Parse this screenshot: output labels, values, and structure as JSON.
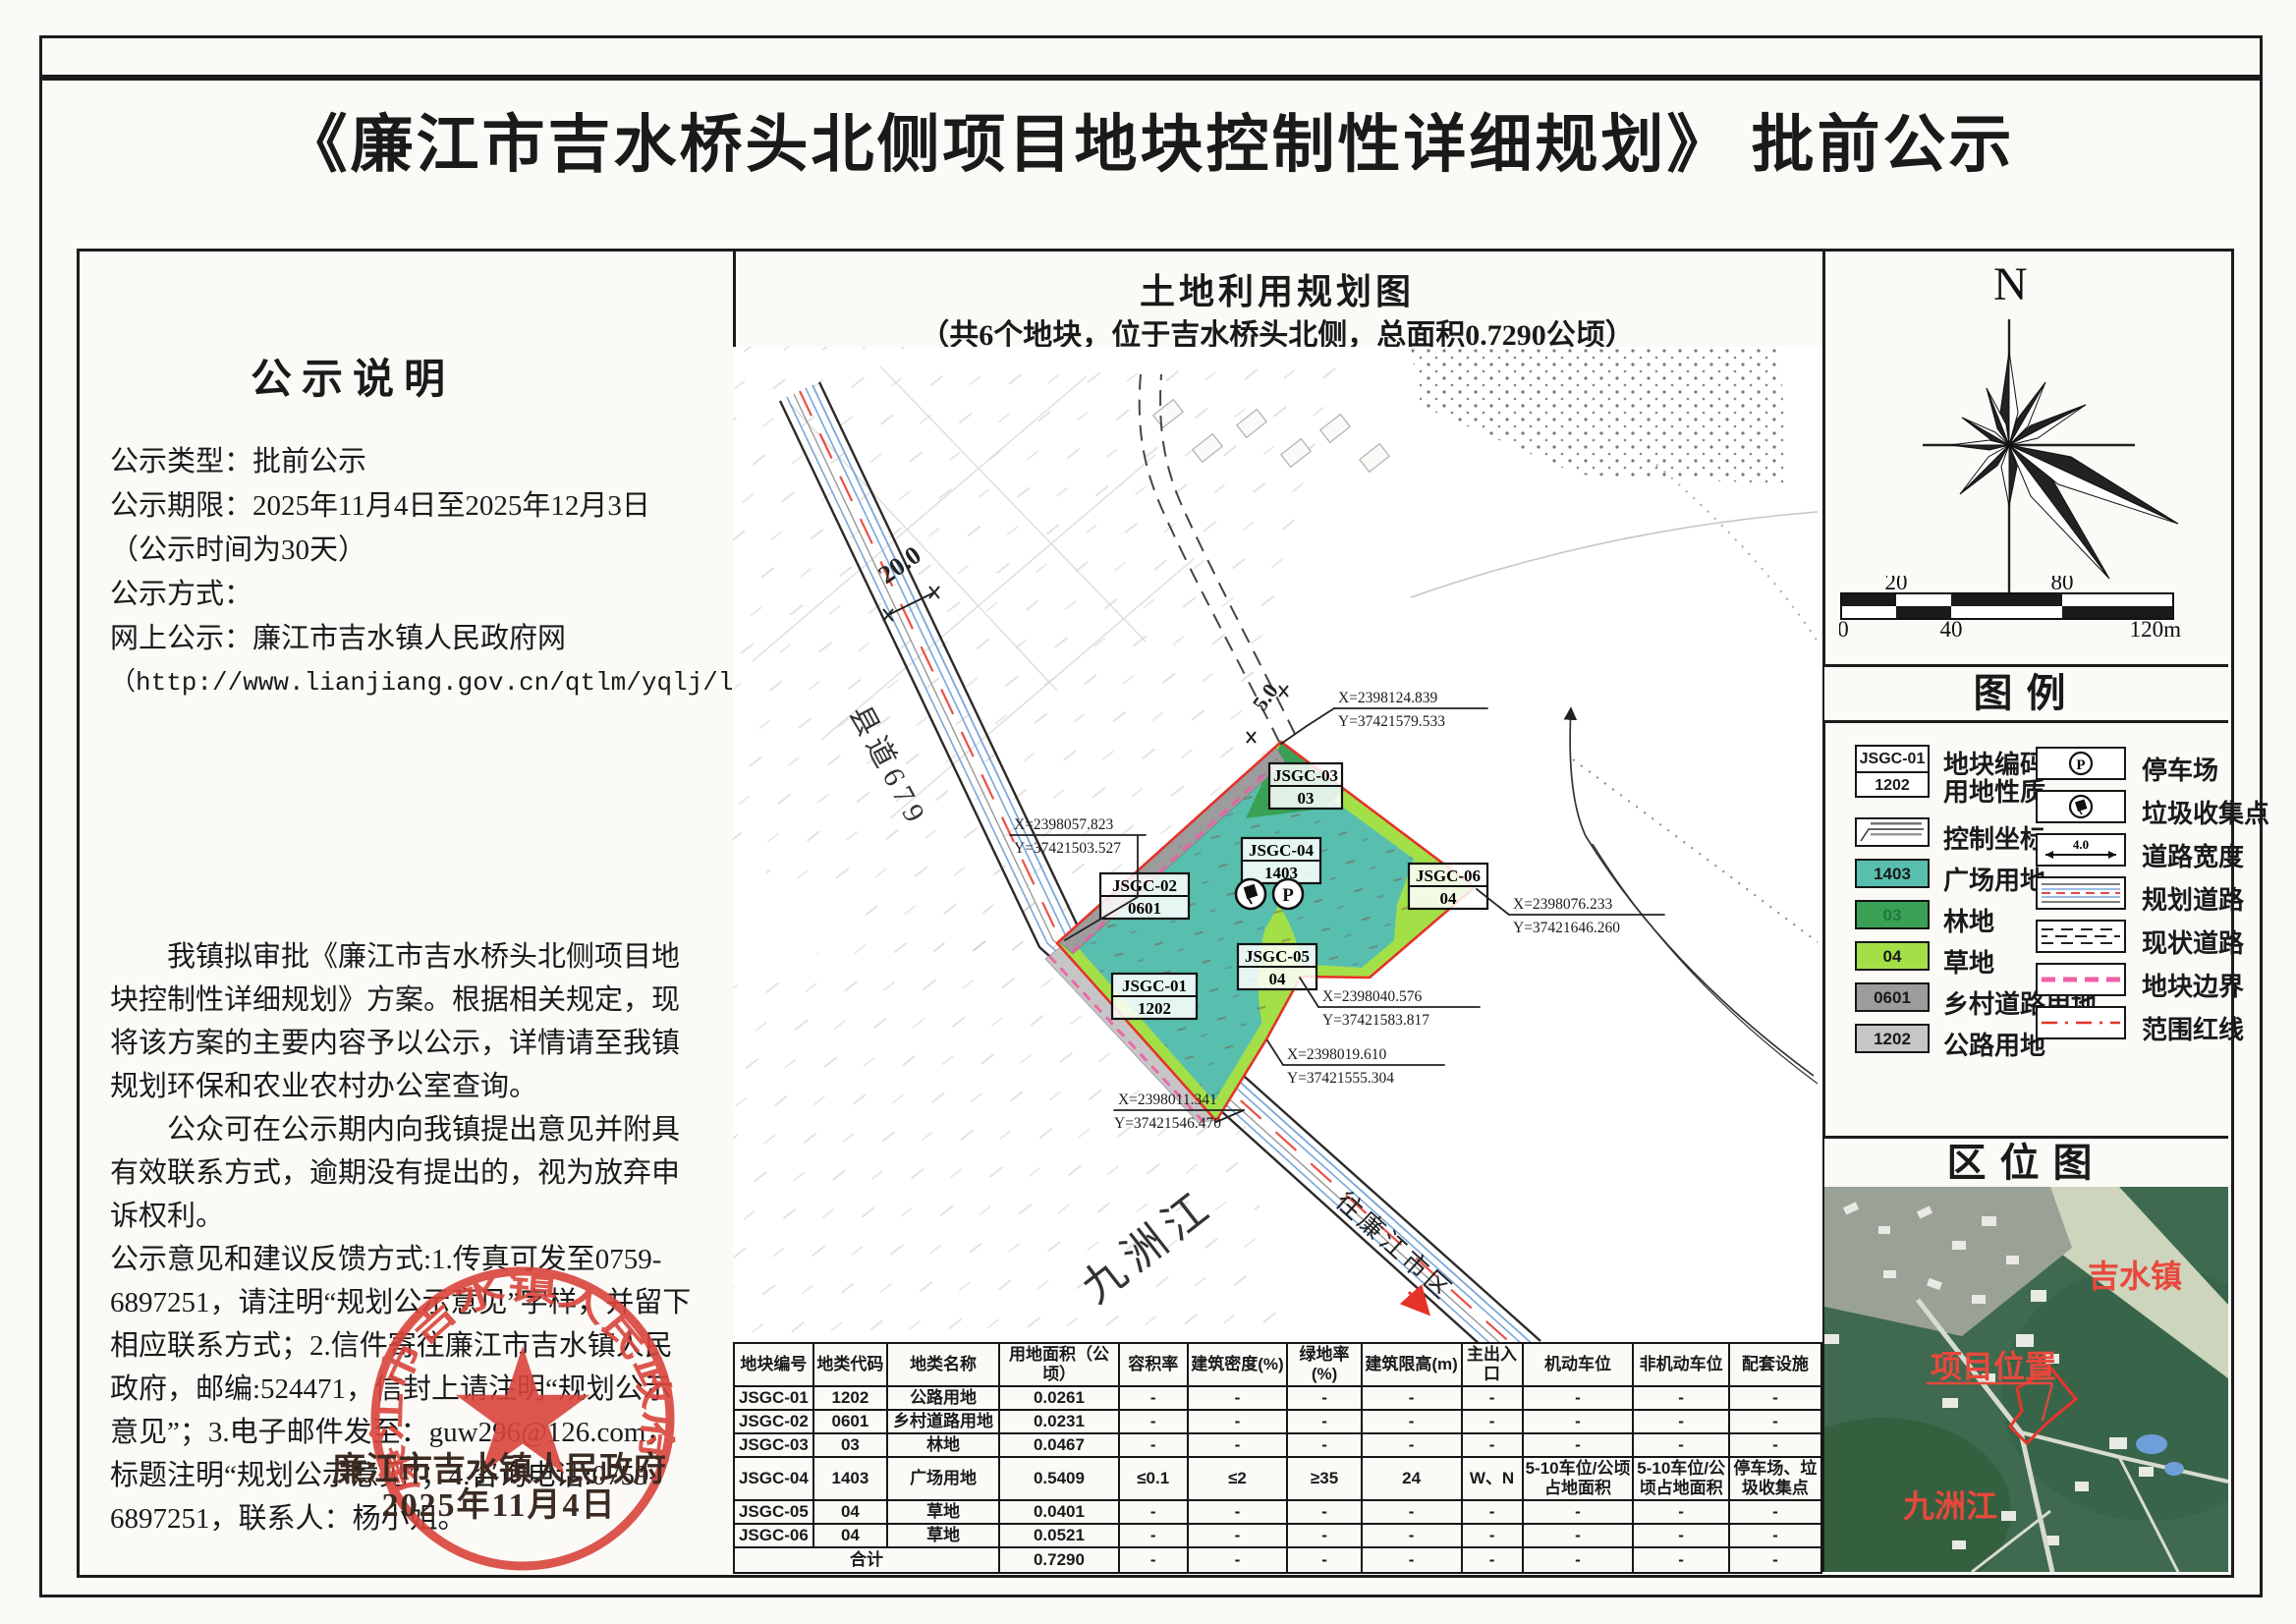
{
  "title": "《廉江市吉水桥头北侧项目地块控制性详细规划》 批前公示",
  "notice": {
    "heading": "公示说明",
    "info_lines": [
      "公示类型：批前公示",
      "公示期限：2025年11月4日至2025年12月3日（公示时间为30天）",
      "公示方式：",
      "网上公示：廉江市吉水镇人民政府网",
      "（http://www.lianjiang.gov.cn/qtlm/yqlj/ljzfbm/ljsjszrmzf/index.html）"
    ],
    "para1": "我镇拟审批《廉江市吉水桥头北侧项目地块控制性详细规划》方案。根据相关规定，现将该方案的主要内容予以公示，详情请至我镇规划环保和农业农村办公室查询。",
    "para2": "公众可在公示期内向我镇提出意见并附具有效联系方式，逾期没有提出的，视为放弃申诉权利。",
    "para3": "公示意见和建议反馈方式:1.传真可发至0759-6897251，请注明“规划公示意见”字样，并留下相应联系方式；2.信件寄往廉江市吉水镇人民政府，邮编:524471，信封上请注明“规划公示意见”；3.电子邮件发至：guw296@126.com，标题注明“规划公示意见”；4.咨询电话:0759-6897251，联系人：杨小姐。"
  },
  "stamp": {
    "seal_text": "廉江市吉水镇人民政府",
    "org": "廉江市吉水镇人民政府",
    "date": "2025年11月4日"
  },
  "map": {
    "title": "土地利用规划图",
    "subtitle": "（共6个地块，位于吉水桥头北侧，总面积0.7290公顷）",
    "road_name": "县道679",
    "road_width": "20.0",
    "lane_width": "5.0",
    "direction_label": "往廉江市区",
    "river_label": "九洲江",
    "labels": [
      {
        "id": "JSGC-01",
        "code": "1202"
      },
      {
        "id": "JSGC-02",
        "code": "0601"
      },
      {
        "id": "JSGC-03",
        "code": "03"
      },
      {
        "id": "JSGC-04",
        "code": "1403"
      },
      {
        "id": "JSGC-05",
        "code": "04"
      },
      {
        "id": "JSGC-06",
        "code": "04"
      }
    ],
    "coords": [
      {
        "x": "X=2398124.839",
        "y": "Y=37421579.533"
      },
      {
        "x": "X=2398057.823",
        "y": "Y=37421503.527"
      },
      {
        "x": "X=2398076.233",
        "y": "Y=37421646.260"
      },
      {
        "x": "X=2398040.576",
        "y": "Y=37421583.817"
      },
      {
        "x": "X=2398019.610",
        "y": "Y=37421555.304"
      },
      {
        "x": "X=2398011.341",
        "y": "Y=37421546.470"
      }
    ]
  },
  "compass": {
    "north": "N"
  },
  "scalebar": {
    "t20": "20",
    "t80": "80",
    "b0": "0",
    "b40": "40",
    "b120": "120m"
  },
  "legend": {
    "title": "图例",
    "sample_id": "JSGC-01",
    "sample_use": "1202",
    "plot_code_label": "地块编码",
    "land_use_label": "用地性质",
    "control_coord_label": "控制坐标",
    "items_left": [
      {
        "code": "1403",
        "label": "广场用地"
      },
      {
        "code": "03",
        "label": "林地"
      },
      {
        "code": "04",
        "label": "草地"
      },
      {
        "code": "0601",
        "label": "乡村道路用地"
      },
      {
        "code": "1202",
        "label": "公路用地"
      }
    ],
    "items_right": [
      {
        "label": "停车场"
      },
      {
        "label": "垃圾收集点"
      },
      {
        "label": "道路宽度",
        "value": "4.0"
      },
      {
        "label": "规划道路"
      },
      {
        "label": "现状道路"
      },
      {
        "label": "地块边界"
      },
      {
        "label": "范围红线"
      }
    ],
    "parking_glyph": "P"
  },
  "location": {
    "title": "区位图",
    "town": "吉水镇",
    "site": "项目位置",
    "river": "九洲江"
  },
  "table": {
    "headers": [
      "地块编号",
      "地类代码",
      "地类名称",
      "用地面积（公顷）",
      "容积率",
      "建筑密度(%)",
      "绿地率(%)",
      "建筑限高(m)",
      "主出入口",
      "机动车位",
      "非机动车位",
      "配套设施"
    ],
    "rows": [
      [
        "JSGC-01",
        "1202",
        "公路用地",
        "0.0261",
        "-",
        "-",
        "-",
        "-",
        "-",
        "-",
        "-",
        "-"
      ],
      [
        "JSGC-02",
        "0601",
        "乡村道路用地",
        "0.0231",
        "-",
        "-",
        "-",
        "-",
        "-",
        "-",
        "-",
        "-"
      ],
      [
        "JSGC-03",
        "03",
        "林地",
        "0.0467",
        "-",
        "-",
        "-",
        "-",
        "-",
        "-",
        "-",
        "-"
      ],
      [
        "JSGC-04",
        "1403",
        "广场用地",
        "0.5409",
        "≤0.1",
        "≤2",
        "≥35",
        "24",
        "W、N",
        "5-10车位/公顷占地面积",
        "5-10车位/公顷占地面积",
        "停车场、垃圾收集点"
      ],
      [
        "JSGC-05",
        "04",
        "草地",
        "0.0401",
        "-",
        "-",
        "-",
        "-",
        "-",
        "-",
        "-",
        "-"
      ],
      [
        "JSGC-06",
        "04",
        "草地",
        "0.0521",
        "-",
        "-",
        "-",
        "-",
        "-",
        "-",
        "-",
        "-"
      ]
    ],
    "total_label": "合计",
    "total_cells": [
      "0.7290",
      "-",
      "-",
      "-",
      "-",
      "-",
      "-",
      "-",
      "-"
    ]
  },
  "colors": {
    "teal": "#58bfae",
    "forest": "#3aa055",
    "grass": "#a3e048",
    "village_gray": "#9c9c9c",
    "highway_gray": "#c6c6c6",
    "red": "#e63228",
    "pink": "#f05fa8",
    "roadblue": "#7aa7d8",
    "seal": "#d9453c",
    "ink": "#1a1a1a"
  }
}
